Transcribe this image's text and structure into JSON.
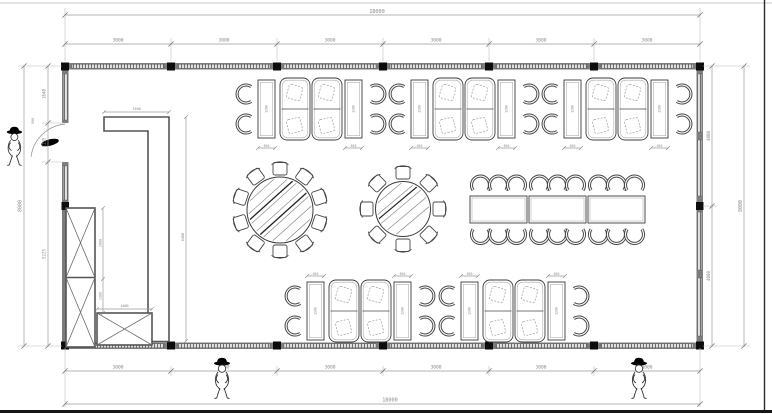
{
  "dimensions": {
    "top": {
      "total": "18000",
      "segments": [
        "3000",
        "3000",
        "3000",
        "3000",
        "3000",
        "3000"
      ]
    },
    "bottom": {
      "total": "18000",
      "segments": [
        "3000",
        "3000",
        "3000",
        "3000",
        "3000",
        "3000"
      ]
    },
    "left": {
      "total": "8000",
      "segments": [
        "1640",
        "1135",
        "5225"
      ],
      "door_width": "900"
    },
    "right": {
      "total": "8000",
      "segments": [
        "4000",
        "4000"
      ]
    },
    "counter": {
      "width": "1500",
      "length": "6400"
    },
    "cabinet": {
      "upper_height": "2000",
      "lower_height": "1900",
      "base_width": "1600"
    },
    "booth": {
      "table_width": "650",
      "table_length": "1200"
    }
  },
  "colors": {
    "line": "#3c3c3c",
    "wall": "#787878",
    "dim": "#8a8a8a",
    "accent": "#000000"
  }
}
